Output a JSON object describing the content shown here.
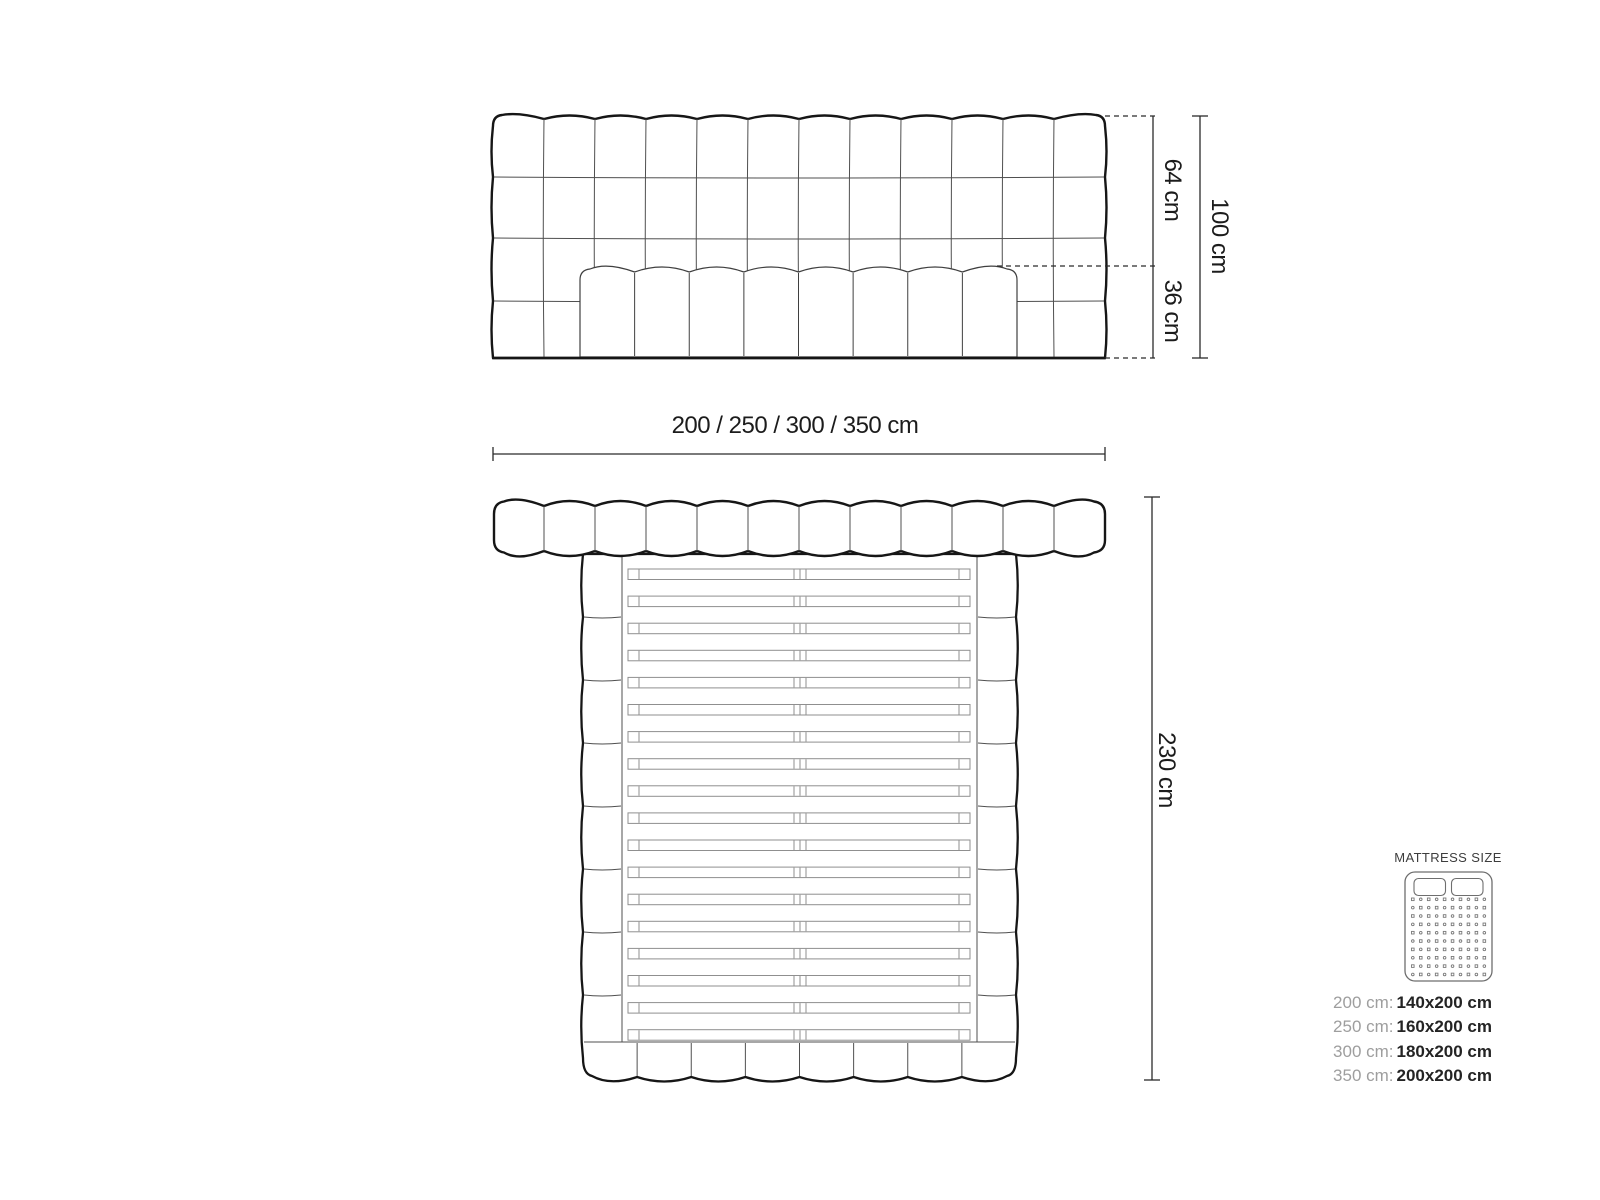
{
  "colors": {
    "outline": "#161616",
    "grid": "#4f4f4f",
    "mattress_line": "#3f3f3f",
    "slat": "#8f8f8f",
    "dim": "#2b2b2b",
    "text": "#1c1c1c",
    "legend_title": "#3d3d3d",
    "legend_muted": "#9e9e9e",
    "legend_value": "#242424",
    "icon_stroke": "#6e6e6e",
    "icon_dot": "#787878"
  },
  "front_view": {
    "headboard_columns": 12,
    "headboard_rows": 4,
    "mattress_columns": 8,
    "dim_upper": "64 cm",
    "dim_lower": "36 cm",
    "dim_total": "100 cm",
    "dim_width": "200 / 250 / 300 / 350 cm"
  },
  "top_view": {
    "headboard_segments": 12,
    "footer_segments": 8,
    "rail_segments": 8,
    "slat_count": 18,
    "dim_length": "230 cm"
  },
  "legend": {
    "title": "MATTRESS SIZE",
    "mattress_icon": {
      "pillows": 2,
      "dot_rows": 10,
      "dot_cols": 10
    },
    "sizes": [
      {
        "frame": "200 cm:",
        "mattress": "140x200 cm"
      },
      {
        "frame": "250 cm:",
        "mattress": "160x200 cm"
      },
      {
        "frame": "300 cm:",
        "mattress": "180x200 cm"
      },
      {
        "frame": "350 cm:",
        "mattress": "200x200 cm"
      }
    ]
  }
}
